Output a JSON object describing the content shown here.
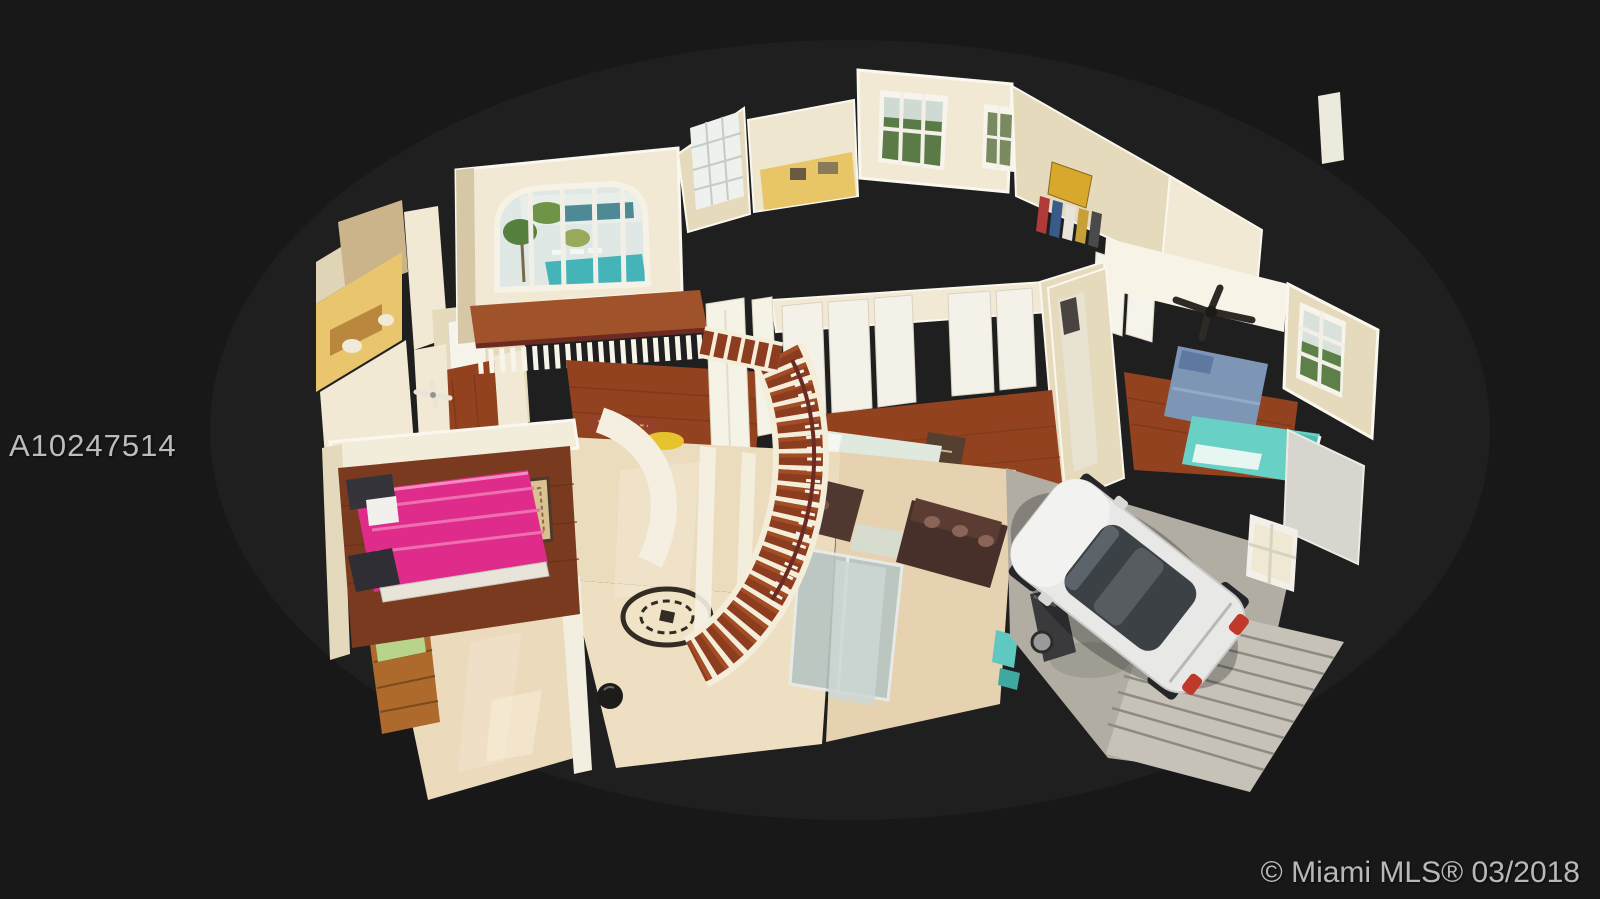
{
  "image": {
    "kind": "3D dollhouse cutaway floor-plan photo of a two-story home",
    "watermark": "A10247514",
    "copyright": "© Miami MLS® 03/2018"
  },
  "scene": {
    "rooms": [
      "home-office-nook",
      "kitchen",
      "bathroom",
      "upstairs-hallway",
      "balcony-landing",
      "pink-bedroom",
      "master-bedroom",
      "kids-bedroom-blue-teal",
      "curved-staircase",
      "marble-foyer-with-medallion",
      "living-room",
      "garage-with-white-car"
    ],
    "view": "aerial oblique, dark background"
  },
  "colors": {
    "background": "#181818",
    "background_glow": "#1f1f1f",
    "watermark_text": "#bdbcbb",
    "copyright_text": "#b9b8b6",
    "wall_light": "#f2e9d5",
    "wall_mid": "#e6dabc",
    "wall_dark": "#d6c8a6",
    "wall_white": "#f7f4ea",
    "wood_floor": "#93421f",
    "wood_floor_dark": "#7a3a1f",
    "wood_floor_light": "#a0522a",
    "marble_floor": "#ecdcbe",
    "marble_floor_b": "#eedfc2",
    "pink_bed": "#df2c8a",
    "pink_bed_fold": "#ee6fb0",
    "blue_bed": "#7e96b6",
    "teal_bed": "#68d0c5",
    "sage_bed": "#e0e9dd",
    "sofa_brown": "#47302a",
    "car_body": "#e8e8e6",
    "car_glass": "#3c4146",
    "tail_light_red": "#c0392b",
    "garage_floor": "#b1ada3",
    "garage_door": "#c6c2b8",
    "pool_water": "#45b4b8",
    "palm_green": "#55803d",
    "stair_wood": "#8d3d1f",
    "rail_wood": "#6b2a22",
    "medallion_dark": "#332c24",
    "kitchen_glow": "#e8c566",
    "cabinet_wood": "#ad6a2c",
    "cushion_green": "#b7d48a",
    "rug_beige": "#d9c190",
    "fan_dark": "#2e2a26"
  }
}
